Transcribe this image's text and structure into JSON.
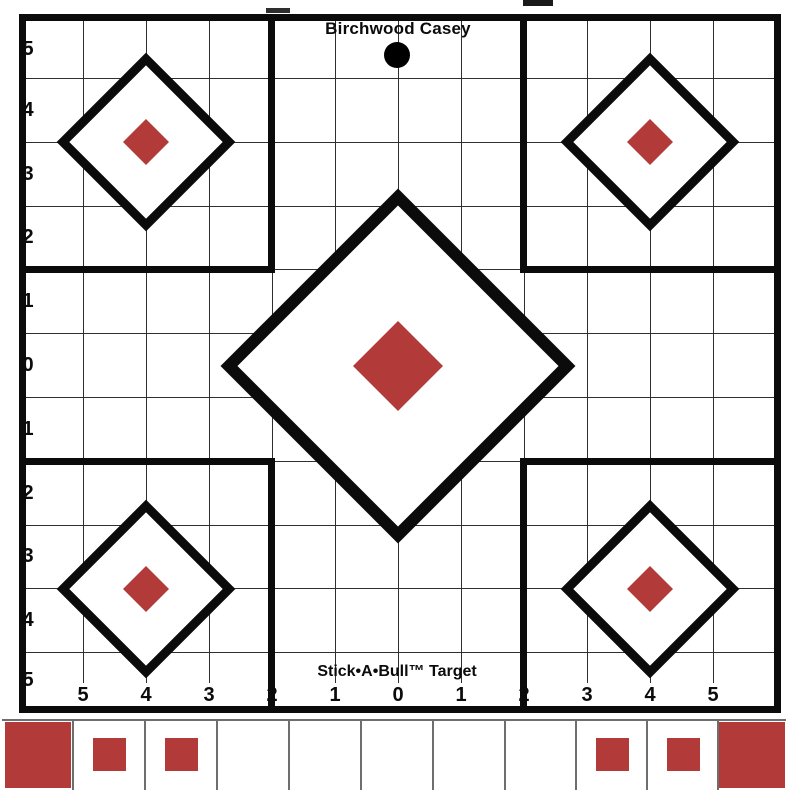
{
  "brand": "Birchwood Casey",
  "product": "Stick•A•Bull™ Target",
  "axis": {
    "left": [
      "5",
      "4",
      "3",
      "2",
      "1",
      "0",
      "1",
      "2",
      "3",
      "4",
      "5"
    ],
    "bottom": [
      "5",
      "4",
      "3",
      "2",
      "1",
      "0",
      "1",
      "2",
      "3",
      "4",
      "5"
    ]
  },
  "colors": {
    "red": "#b23a38",
    "line": "#0b0b0b",
    "grid": "#2f2f2f",
    "strip_line": "#6e6e6e"
  },
  "strip_cells": [
    "large",
    "small",
    "small",
    "none",
    "none",
    "none",
    "none",
    "none",
    "small",
    "small",
    "large"
  ]
}
